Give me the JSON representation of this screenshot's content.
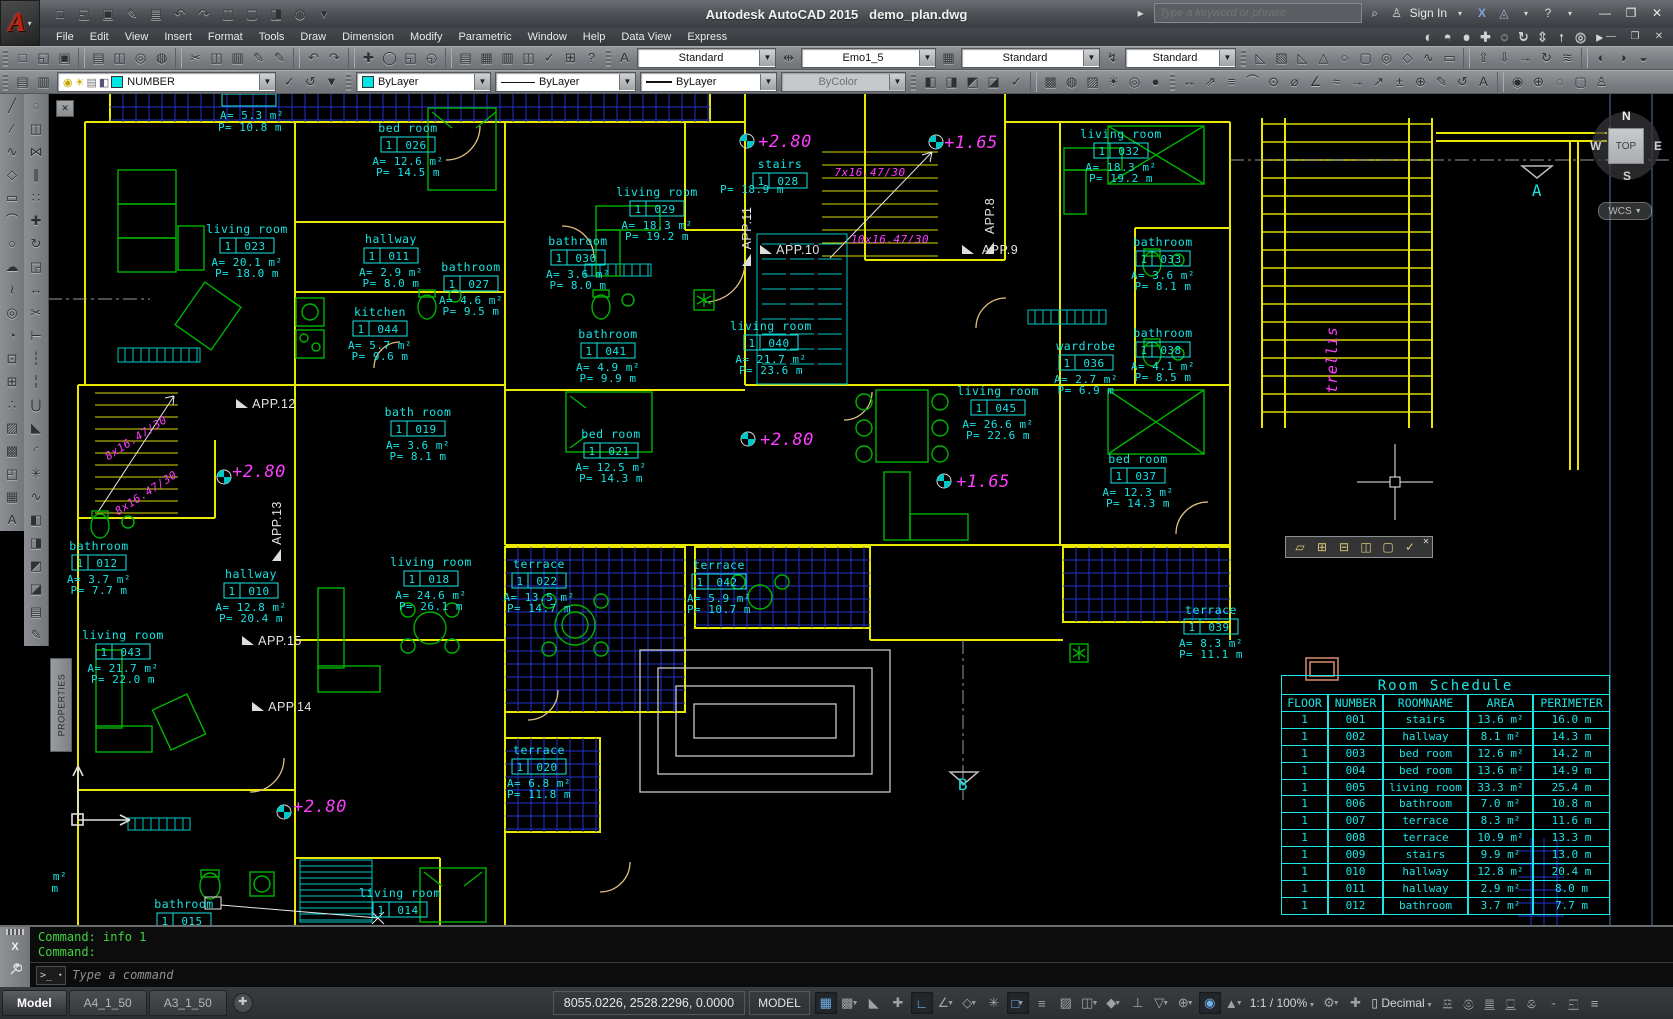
{
  "app": {
    "vendor_title": "Autodesk AutoCAD 2015",
    "doc_title": "demo_plan.dwg"
  },
  "titlebar": {
    "search_placeholder": "Type a keyword or phrase",
    "signin_label": "Sign In",
    "qat_icons": [
      "new",
      "open",
      "save",
      "save-as",
      "plot",
      "undo",
      "redo",
      "doc-compare",
      "doc-restore",
      "doc-transfer",
      "render-sphere",
      "customize"
    ]
  },
  "menubar": {
    "items": [
      "File",
      "Edit",
      "View",
      "Insert",
      "Format",
      "Tools",
      "Draw",
      "Dimension",
      "Modify",
      "Parametric",
      "Window",
      "Help",
      "Data View",
      "Express"
    ],
    "nav_icons": [
      "vs-2d-wireframe",
      "vs-conceptual",
      "vs-realistic",
      "3d-pan",
      "3d-orbit",
      "3d-swivel",
      "3d-distance",
      "3d-walk",
      "steering-wheel",
      "show-motion"
    ]
  },
  "toolbars": {
    "std_groups": [
      [
        "new",
        "open",
        "save"
      ],
      [
        "plot",
        "plot-preview",
        "publish",
        "publish-web"
      ],
      [
        "cut",
        "copy",
        "paste",
        "match-properties",
        "match-block"
      ],
      [
        "undo",
        "redo"
      ],
      [
        "pan",
        "zoom-realtime",
        "zoom-window",
        "zoom-previous"
      ],
      [
        "properties-palette",
        "design-center",
        "tool-palettes",
        "sheet-set-manager",
        "markup",
        "quick-calc",
        "help"
      ]
    ],
    "styles": {
      "text_style": "Standard",
      "dim_style": "Emo1_5",
      "table_style": "Standard",
      "mleader_style": "Standard"
    },
    "solids_icons": [
      "polysolid",
      "box",
      "wedge",
      "cone",
      "sphere",
      "cylinder",
      "torus",
      "pyramid",
      "helix",
      "planar-surface"
    ],
    "solids_icons2": [
      "extrude",
      "presspull",
      "sweep",
      "revolve",
      "loft"
    ],
    "visual_icons": [
      "vs-2d-wireframe",
      "vs-wireframe",
      "vs-hidden"
    ],
    "layers": {
      "layer_name": "NUMBER",
      "pre_icons": [
        "layer-properties",
        "layer-filters"
      ],
      "post_icons": [
        "make-current",
        "layer-previous",
        "layer-states"
      ]
    },
    "properties": {
      "color": "ByLayer",
      "linetype": "ByLayer",
      "lineweight": "ByLayer",
      "plot_style": "ByColor"
    },
    "right_groups": [
      [
        "draworder-bring-front",
        "draworder-send-back",
        "draworder-bring-above",
        "draworder-send-under"
      ],
      [
        "spell-check"
      ],
      [
        "render-region",
        "materials",
        "material-mapping",
        "lights",
        "render-environment",
        "advanced-render"
      ],
      [
        "dim-linear",
        "dim-aligned",
        "dim-baseline",
        "dim-arc",
        "dim-radius",
        "dim-diameter",
        "dim-angular",
        "dim-quick",
        "dim-continue",
        "dim-leader",
        "dim-tolerance",
        "dim-center",
        "dim-edit",
        "dim-update",
        "dim-style"
      ],
      [
        "geographic-location",
        "mark-position",
        "clean",
        "named-views",
        "user"
      ]
    ]
  },
  "panels": {
    "properties_tab": "PROPERTIES"
  },
  "draw_tools": [
    "line",
    "construction-line",
    "polyline",
    "polygon",
    "rectangle",
    "arc",
    "circle",
    "revision-cloud",
    "spline",
    "ellipse",
    "ellipse-arc",
    "insert-block",
    "create-block",
    "point",
    "hatch",
    "gradient",
    "region",
    "table",
    "multiline-text"
  ],
  "modify_tools": [
    "erase",
    "copy",
    "mirror",
    "offset",
    "array",
    "move",
    "rotate",
    "scale",
    "stretch",
    "trim",
    "extend",
    "break-at-point",
    "break",
    "join",
    "chamfer",
    "fillet",
    "explode",
    "pedit",
    "draworder-front",
    "draworder-back",
    "draworder-above",
    "draworder-under",
    "properties-palette",
    "match-properties"
  ],
  "viewcube": {
    "n": "N",
    "w": "W",
    "s": "S",
    "e": "E",
    "face": "TOP",
    "wcs": "WCS"
  },
  "refedit": {
    "icons": [
      "edit-reference",
      "add-to-working-set",
      "remove-from-working-set",
      "open-reference",
      "close-reference",
      "save-reference-edits"
    ]
  },
  "plan": {
    "floor_tag": "1",
    "rooms": [
      {
        "n": "bed room",
        "num": "026",
        "a": "A= 12.6 m²",
        "p": "P= 14.5 m",
        "x": 408,
        "y": 132
      },
      {
        "n": "living room",
        "num": "023",
        "a": "A= 20.1 m²",
        "p": "P= 18.0 m",
        "x": 247,
        "y": 233
      },
      {
        "n": "hallway",
        "num": "011",
        "a": "A= 2.9 m²",
        "p": "P= 8.0 m",
        "x": 391,
        "y": 243
      },
      {
        "n": "bathroom",
        "num": "027",
        "a": "A= 4.6 m²",
        "p": "P= 9.5 m",
        "x": 471,
        "y": 271
      },
      {
        "n": "kitchen",
        "num": "044",
        "a": "A= 5.7 m²",
        "p": "P= 9.6 m",
        "x": 380,
        "y": 316
      },
      {
        "n": "living room",
        "num": "029",
        "a": "A= 18.3 m²",
        "p": "P= 19.2 m",
        "x": 657,
        "y": 196
      },
      {
        "n": "bathroom",
        "num": "030",
        "a": "A= 3.6 m²",
        "p": "P= 8.0 m",
        "x": 578,
        "y": 245
      },
      {
        "n": "stairs",
        "num": "028",
        "a": "",
        "p": "",
        "x": 780,
        "y": 168
      },
      {
        "n": "living room",
        "num": "040",
        "a": "A= 21.7 m²",
        "p": "P= 23.6 m",
        "x": 771,
        "y": 330
      },
      {
        "n": "bathroom",
        "num": "041",
        "a": "A= 4.9 m²",
        "p": "P= 9.9 m",
        "x": 608,
        "y": 338
      },
      {
        "n": "bed room",
        "num": "021",
        "a": "A= 12.5 m²",
        "p": "P= 14.3 m",
        "x": 611,
        "y": 438
      },
      {
        "n": "living room",
        "num": "032",
        "a": "A= 18.3 m²",
        "p": "P= 19.2 m",
        "x": 1121,
        "y": 138
      },
      {
        "n": "bathroom",
        "num": "033",
        "a": "A= 3.6 m²",
        "p": "P= 8.1 m",
        "x": 1163,
        "y": 246
      },
      {
        "n": "bathroom",
        "num": "038",
        "a": "A= 4.1 m²",
        "p": "P= 8.5 m",
        "x": 1163,
        "y": 337
      },
      {
        "n": "wardrobe",
        "num": "036",
        "a": "A= 2.7 m²",
        "p": "P= 6.9 m",
        "x": 1086,
        "y": 350
      },
      {
        "n": "living room",
        "num": "045",
        "a": "A= 26.6 m²",
        "p": "P= 22.6 m",
        "x": 998,
        "y": 395
      },
      {
        "n": "bed room",
        "num": "037",
        "a": "A= 12.3 m²",
        "p": "P= 14.3 m",
        "x": 1138,
        "y": 463
      },
      {
        "n": "bath room",
        "num": "019",
        "a": "A= 3.6 m²",
        "p": "P= 8.1 m",
        "x": 418,
        "y": 416
      },
      {
        "n": "living room",
        "num": "018",
        "a": "A= 24.6 m²",
        "p": "P= 26.1 m",
        "x": 431,
        "y": 566
      },
      {
        "n": "hallway",
        "num": "010",
        "a": "A= 12.8 m²",
        "p": "P= 20.4 m",
        "x": 251,
        "y": 578
      },
      {
        "n": "bathroom",
        "num": "012",
        "a": "A= 3.7 m²",
        "p": "P= 7.7 m",
        "x": 99,
        "y": 550
      },
      {
        "n": "living room",
        "num": "043",
        "a": "A= 21.7 m²",
        "p": "P= 22.0 m",
        "x": 123,
        "y": 639
      },
      {
        "n": "terrace",
        "num": "022",
        "a": "A= 13.5 m²",
        "p": "P= 14.7 m",
        "x": 539,
        "y": 568
      },
      {
        "n": "terrace",
        "num": "042",
        "a": "A= 5.9 m²",
        "p": "P= 10.7 m",
        "x": 719,
        "y": 569
      },
      {
        "n": "terrace",
        "num": "039",
        "a": "A= 8.3 m²",
        "p": "P= 11.1 m",
        "x": 1211,
        "y": 614
      },
      {
        "n": "terrace",
        "num": "020",
        "a": "A= 6.8 m²",
        "p": "P= 11.8 m",
        "x": 539,
        "y": 754
      },
      {
        "n": "living room",
        "num": "014",
        "a": "",
        "p": "",
        "x": 400,
        "y": 897
      },
      {
        "n": "bathroom",
        "num": "015",
        "a": "",
        "p": "",
        "x": 184,
        "y": 908
      }
    ],
    "loose_texts": [
      {
        "t": "A= 5.3 m²",
        "x": 252,
        "y": 119
      },
      {
        "t": "P= 10.8 m",
        "x": 250,
        "y": 131
      },
      {
        "t": "P= 18.9 m",
        "x": 752,
        "y": 193
      },
      {
        "t": "m²",
        "x": 60,
        "y": 880
      },
      {
        "t": "m",
        "x": 55,
        "y": 892
      }
    ],
    "annotations": [
      {
        "t": "+2.80",
        "x": 785,
        "y": 147,
        "s": 17
      },
      {
        "t": "+1.65",
        "x": 971,
        "y": 148,
        "s": 17
      },
      {
        "t": "+2.80",
        "x": 787,
        "y": 445,
        "s": 17
      },
      {
        "t": "+1.65",
        "x": 983,
        "y": 487,
        "s": 17
      },
      {
        "t": "+2.80",
        "x": 259,
        "y": 477,
        "s": 17
      },
      {
        "t": "+2.80",
        "x": 320,
        "y": 812,
        "s": 17
      },
      {
        "t": "7x16.47/30",
        "x": 870,
        "y": 176,
        "s": 11
      },
      {
        "t": "10x16.47/30",
        "x": 890,
        "y": 243,
        "s": 11
      },
      {
        "t": "8x16.47/30",
        "x": 138,
        "y": 441,
        "s": 11,
        "r": -33
      },
      {
        "t": "8x16.47/30",
        "x": 148,
        "y": 496,
        "s": 11,
        "r": -33
      },
      {
        "t": "trellis",
        "x": 1337,
        "y": 360,
        "s": 15,
        "r": -90
      }
    ],
    "apps": [
      {
        "t": "APP.12",
        "x": 262,
        "y": 408,
        "r": 0
      },
      {
        "t": "APP.13",
        "x": 281,
        "y": 535,
        "r": -90
      },
      {
        "t": "APP.15",
        "x": 268,
        "y": 645,
        "r": 0
      },
      {
        "t": "APP.14",
        "x": 278,
        "y": 711,
        "r": 0
      },
      {
        "t": "APP.11",
        "x": 751,
        "y": 240,
        "r": -90
      },
      {
        "t": "APP.10",
        "x": 786,
        "y": 254,
        "r": 0
      },
      {
        "t": "APP.9",
        "x": 988,
        "y": 254,
        "r": 0
      },
      {
        "t": "APP.8",
        "x": 994,
        "y": 228,
        "r": -90
      }
    ],
    "sections": [
      {
        "t": "A",
        "x": 1537,
        "y": 196
      },
      {
        "t": "B",
        "x": 963,
        "y": 790
      }
    ]
  },
  "schedule": {
    "title": "Room Schedule",
    "columns": [
      "FLOOR",
      "NUMBER",
      "ROOMNAME",
      "AREA",
      "PERIMETER"
    ],
    "rows": [
      [
        "1",
        "001",
        "stairs",
        "13.6 m²",
        "16.0 m"
      ],
      [
        "1",
        "002",
        "hallway",
        "8.1 m²",
        "14.3 m"
      ],
      [
        "1",
        "003",
        "bed room",
        "12.6 m²",
        "14.2 m"
      ],
      [
        "1",
        "004",
        "bed room",
        "13.6 m²",
        "14.9 m"
      ],
      [
        "1",
        "005",
        "living room",
        "33.3 m²",
        "25.4 m"
      ],
      [
        "1",
        "006",
        "bathroom",
        "7.0 m²",
        "10.8 m"
      ],
      [
        "1",
        "007",
        "terrace",
        "8.3 m²",
        "11.6 m"
      ],
      [
        "1",
        "008",
        "terrace",
        "10.9 m²",
        "13.3 m"
      ],
      [
        "1",
        "009",
        "stairs",
        "9.9 m²",
        "13.0 m"
      ],
      [
        "1",
        "010",
        "hallway",
        "12.8 m²",
        "20.4 m"
      ],
      [
        "1",
        "011",
        "hallway",
        "2.9 m²",
        "8.0 m"
      ],
      [
        "1",
        "012",
        "bathroom",
        "3.7 m²",
        "7.7 m"
      ]
    ]
  },
  "command": {
    "history": [
      "Command: info 1",
      "Command:"
    ],
    "placeholder": "Type a command"
  },
  "statusbar": {
    "tabs": [
      "Model",
      "A4_1_50",
      "A3_1_50"
    ],
    "coords": "8055.0226, 2528.2296, 0.0000",
    "space": "MODEL",
    "toggles": [
      {
        "n": "grid-display",
        "on": 1
      },
      {
        "n": "snap-mode",
        "dd": 1
      },
      {
        "n": "infer-constraints"
      },
      {
        "n": "dynamic-input"
      },
      {
        "n": "ortho-mode",
        "on": 1
      },
      {
        "n": "polar-tracking",
        "dd": 1
      },
      {
        "n": "isometric-drafting",
        "dd": 1
      },
      {
        "n": "object-snap-tracking"
      },
      {
        "n": "object-snap",
        "on": 1,
        "dd": 1
      },
      {
        "n": "show-lineweight"
      },
      {
        "n": "transparency"
      },
      {
        "n": "selection-cycling",
        "dd": 1
      },
      {
        "n": "3d-object-snap",
        "dd": 1
      },
      {
        "n": "dynamic-ucs"
      },
      {
        "n": "selection-filtering",
        "dd": 1
      },
      {
        "n": "gizmo",
        "dd": 1
      },
      {
        "n": "annotation-visibility",
        "on": 1
      },
      {
        "n": "autoscale",
        "dd": 1
      }
    ],
    "scale": "1:1 / 100%",
    "units": "Decimal",
    "right_icons": [
      "quick-calc",
      "isolate-objects",
      "plot-status",
      "save-settings",
      "hyperlink",
      "performance-monitor",
      "clean-screen",
      "customization"
    ]
  },
  "colors": {
    "wall": "#e8e800",
    "label": "#17e3e3",
    "furniture": "#00b400",
    "annotation": "#ff3dff",
    "terrace_grid": "#2433cf",
    "door": "#dfc080",
    "cmd_text": "#3fd43f"
  }
}
